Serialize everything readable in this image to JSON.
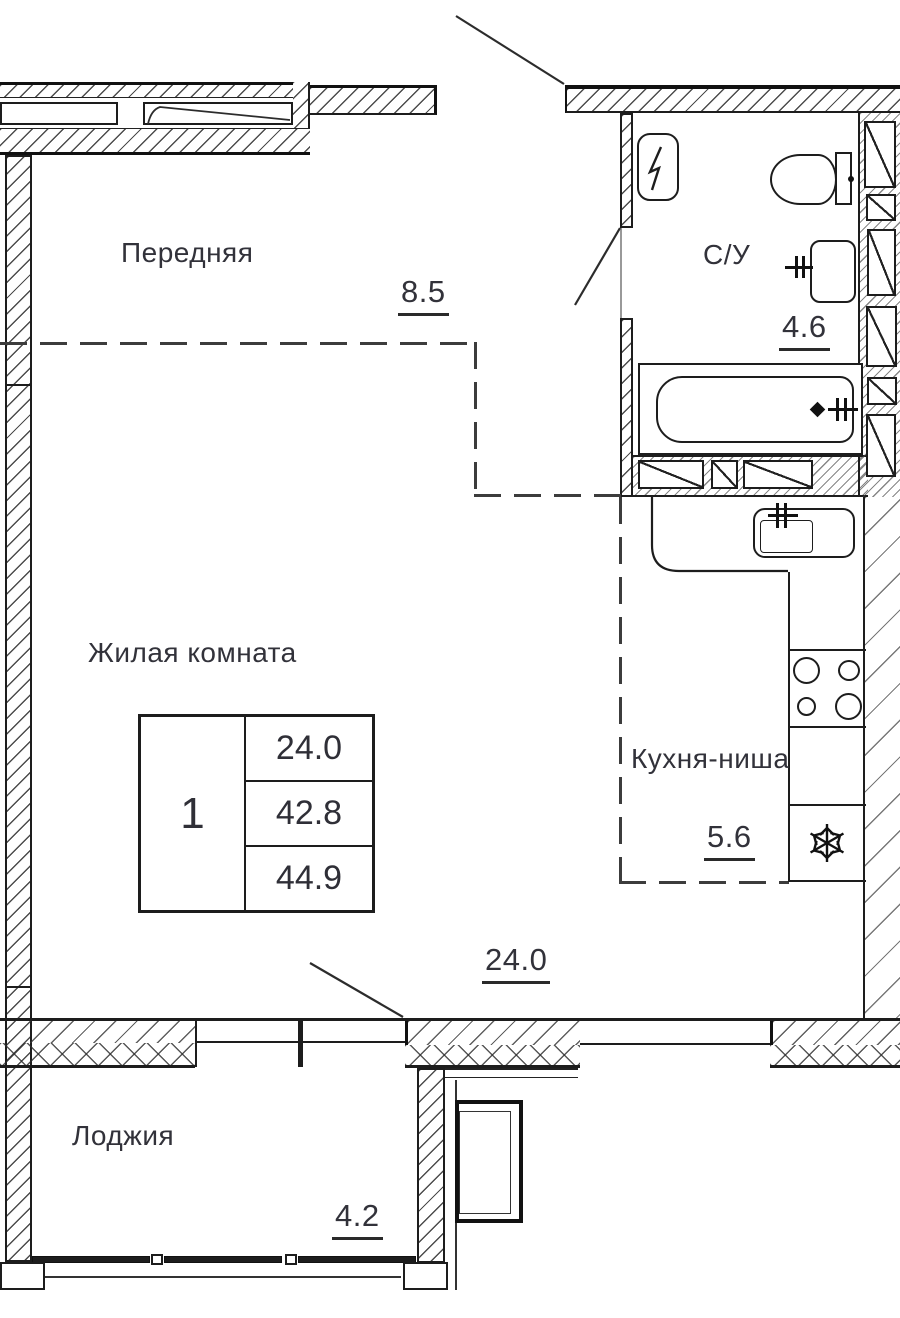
{
  "title": "Apartment floor plan",
  "colors": {
    "line": "#1d1d1d",
    "text": "#32323a",
    "background": "#ffffff"
  },
  "rooms": {
    "hallway": {
      "name": "Передняя",
      "area": "8.5"
    },
    "bathroom": {
      "name": "С/У",
      "area": "4.6"
    },
    "living": {
      "name": "Жилая комната"
    },
    "kitchen": {
      "name": "Кухня-ниша",
      "area": "5.6"
    },
    "main": {
      "area": "24.0"
    },
    "loggia": {
      "name": "Лоджия",
      "area": "4.2"
    }
  },
  "info_table": {
    "rooms_count": "1",
    "rows": [
      "24.0",
      "42.8",
      "44.9"
    ]
  },
  "icons": {
    "fridge": "snowflake-icon",
    "electrical_panel": "lightning-icon"
  }
}
